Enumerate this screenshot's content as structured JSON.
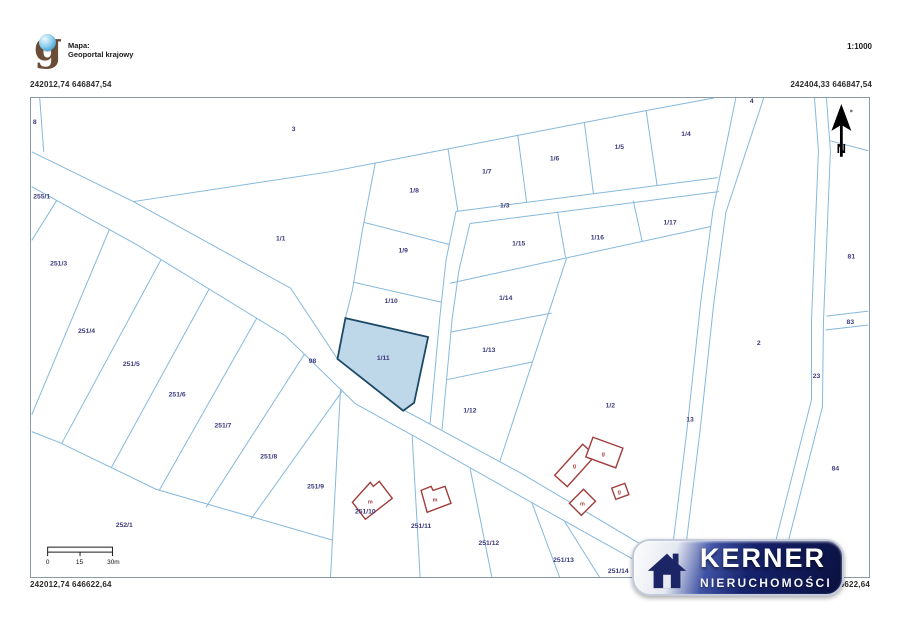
{
  "header": {
    "source_label": "Mapa:",
    "source_name": "Geoportal krajowy",
    "scale_label": "1:1000",
    "logo_letter": "g"
  },
  "coordinates": {
    "top_left": "242012,74 646847,54",
    "top_right": "242404,33 646847,54",
    "bottom_left": "242012,74 646622,64",
    "bottom_right": "242404,33 646622,64"
  },
  "north_arrow": {
    "label": "N"
  },
  "scale_bar": {
    "tick_labels": [
      "0",
      "15",
      "30m"
    ]
  },
  "watermark": {
    "brand": "KERNER",
    "subtitle": "NIERUCHOMOŚCI"
  },
  "colors": {
    "parcel_line": "#85b8dc",
    "parcel_label": "#3c3a7d",
    "building_outline": "#a03d3a",
    "highlight_fill": "#b7d4e7",
    "highlight_stroke": "#1c4966",
    "watermark_navy": "#16226b"
  },
  "map": {
    "highlighted_parcel": {
      "id": "1/11",
      "points": "345,318 428,337 414,403 403,411 337,359"
    },
    "lines": [
      "M30,151 L132,201 L290,288 L337,359 L403,410 L520,473 L660,556",
      "M30,186 L135,244 L285,336 L355,404 L420,440 L560,519 L648,568",
      "M38,97 L42,151",
      "M132,201 L330,171 L650,109 L715,97",
      "M375,162 L362,230 L352,290 L345,318",
      "M364,222 L449,244",
      "M353,282 L441,302",
      "M448,148 L458,211",
      "M518,134 L527,202",
      "M585,122 L594,193",
      "M647,110 L658,185",
      "M456,211 L719,177",
      "M470,223 L720,191",
      "M456,211 L446,260 L440,315 L430,424",
      "M470,223 L459,270 L452,320 L442,430",
      "M450,283 L712,226",
      "M558,211 L566,257",
      "M634,200 L643,241",
      "M451,332 L552,313",
      "M446,380 L533,362",
      "M567,258 L500,462",
      "M737,97 L714,210 L702,300 L688,430 L672,560 L670,578",
      "M765,97 L727,212 L715,302 L701,432 L685,562 L683,578",
      "M816,97 L820,150 L813,320 L813,400 L778,538 L772,578",
      "M828,97 L832,150 L825,322 L824,407 L788,549 L782,578",
      "M832,140 L870,150",
      "M828,316 L870,311",
      "M827,330 L870,325",
      "M30,432 L58,443 L155,490 L332,541",
      "M55,200 L30,240",
      "M108,229 L30,415",
      "M160,259 L60,444",
      "M208,289 L110,468",
      "M256,318 L158,491",
      "M304,354 L205,508",
      "M342,391 L250,520",
      "M340,390 L330,578",
      "M412,436 L420,578",
      "M470,468 L492,578",
      "M532,503 L560,578",
      "M565,522 L600,578"
    ],
    "parcel_labels": [
      {
        "t": "8",
        "x": 33,
        "y": 123
      },
      {
        "t": "3",
        "x": 293,
        "y": 130
      },
      {
        "t": "255/1",
        "x": 40,
        "y": 198
      },
      {
        "t": "1/1",
        "x": 280,
        "y": 240
      },
      {
        "t": "251/3",
        "x": 57,
        "y": 265
      },
      {
        "t": "251/4",
        "x": 85,
        "y": 333
      },
      {
        "t": "251/5",
        "x": 130,
        "y": 366
      },
      {
        "t": "251/6",
        "x": 176,
        "y": 397
      },
      {
        "t": "251/7",
        "x": 222,
        "y": 428
      },
      {
        "t": "251/8",
        "x": 268,
        "y": 459
      },
      {
        "t": "251/9",
        "x": 315,
        "y": 489
      },
      {
        "t": "252/1",
        "x": 123,
        "y": 528
      },
      {
        "t": "98",
        "x": 312,
        "y": 363
      },
      {
        "t": "1/8",
        "x": 414,
        "y": 192
      },
      {
        "t": "1/9",
        "x": 403,
        "y": 252
      },
      {
        "t": "1/10",
        "x": 391,
        "y": 303
      },
      {
        "t": "1/11",
        "x": 383,
        "y": 360
      },
      {
        "t": "1/7",
        "x": 487,
        "y": 173
      },
      {
        "t": "1/6",
        "x": 555,
        "y": 160
      },
      {
        "t": "1/5",
        "x": 620,
        "y": 148
      },
      {
        "t": "1/4",
        "x": 687,
        "y": 135
      },
      {
        "t": "4",
        "x": 753,
        "y": 102
      },
      {
        "t": "1/3",
        "x": 505,
        "y": 207
      },
      {
        "t": "1/15",
        "x": 519,
        "y": 245
      },
      {
        "t": "1/16",
        "x": 598,
        "y": 239
      },
      {
        "t": "1/17",
        "x": 671,
        "y": 224
      },
      {
        "t": "1/14",
        "x": 506,
        "y": 300
      },
      {
        "t": "1/13",
        "x": 489,
        "y": 352
      },
      {
        "t": "1/12",
        "x": 470,
        "y": 413
      },
      {
        "t": "1/2",
        "x": 611,
        "y": 408
      },
      {
        "t": "13",
        "x": 691,
        "y": 422
      },
      {
        "t": "2",
        "x": 760,
        "y": 345
      },
      {
        "t": "81",
        "x": 853,
        "y": 258
      },
      {
        "t": "83",
        "x": 852,
        "y": 324
      },
      {
        "t": "23",
        "x": 818,
        "y": 378
      },
      {
        "t": "84",
        "x": 837,
        "y": 471
      },
      {
        "t": "251/10",
        "x": 365,
        "y": 514
      },
      {
        "t": "251/11",
        "x": 421,
        "y": 529
      },
      {
        "t": "251/12",
        "x": 489,
        "y": 546
      },
      {
        "t": "251/13",
        "x": 564,
        "y": 563
      },
      {
        "t": "251/14",
        "x": 619,
        "y": 574
      }
    ],
    "building_labels": [
      {
        "t": "g",
        "x": 575,
        "y": 468
      },
      {
        "t": "g",
        "x": 604,
        "y": 456
      },
      {
        "t": "g",
        "x": 620,
        "y": 494
      },
      {
        "t": "m",
        "x": 583,
        "y": 506
      },
      {
        "t": "m",
        "x": 370,
        "y": 504
      },
      {
        "t": "m",
        "x": 435,
        "y": 502
      }
    ],
    "buildings": {
      "rects": [
        {
          "cx": 575.5,
          "cy": 466,
          "w": 42,
          "h": 17,
          "rot": -48
        },
        {
          "cx": 605,
          "cy": 453,
          "w": 32,
          "h": 21,
          "rot": 20
        },
        {
          "cx": 621,
          "cy": 492,
          "w": 14,
          "h": 12,
          "rot": -20
        },
        {
          "cx": 583,
          "cy": 503,
          "w": 20,
          "h": 17,
          "rot": -45
        }
      ],
      "polygons": [
        "392,499 379,482 373,487 370,483 352,503 365,520",
        "451,504 445,487 433,491 431,487 421,491 427,513"
      ]
    }
  }
}
